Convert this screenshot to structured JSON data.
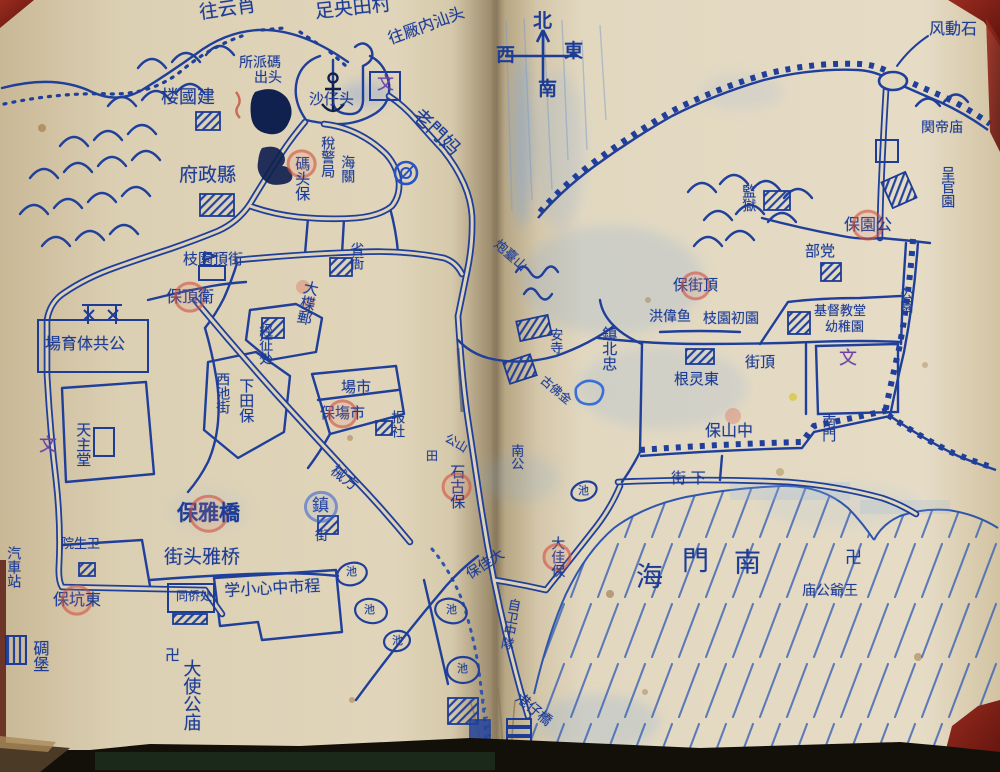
{
  "colors": {
    "ink": "#1c3c96",
    "red_mark": "#cc4a3c",
    "purple": "#7040a8",
    "paper": "#ddd2b6",
    "sea_ink": "#2f56ad"
  },
  "compass": {
    "north": "北",
    "south": "南",
    "east": "東",
    "west": "西"
  },
  "icons": {
    "anchor": "harbor anchor symbol",
    "swastika": "卍 temple mark",
    "compass_arrow": "north arrow cross",
    "wall": "crenellated city wall",
    "pond": "oval pond with 池"
  },
  "map_labels": [
    {
      "id": "route-yunxiao",
      "text": "往云肖",
      "x": 198,
      "y": 4,
      "size": 19,
      "rot": -8
    },
    {
      "id": "route-tianyang",
      "text": "足央田村",
      "x": 314,
      "y": 3,
      "size": 19,
      "rot": -6
    },
    {
      "id": "route-shantou",
      "text": "往厰内汕头",
      "x": 386,
      "y": 32,
      "size": 16,
      "rot": -20
    },
    {
      "id": "paichusuo-line1",
      "text": "所派碼",
      "x": 239,
      "y": 56,
      "size": 14
    },
    {
      "id": "paichusuo-line2",
      "text": "出头",
      "x": 254,
      "y": 71,
      "size": 14
    },
    {
      "id": "jianguolou",
      "text": "楼國建",
      "x": 161,
      "y": 89,
      "size": 18
    },
    {
      "id": "shazaitou",
      "text": "沙仔头",
      "x": 309,
      "y": 92,
      "size": 15
    },
    {
      "id": "wen-top",
      "text": "文",
      "x": 377,
      "y": 76,
      "size": 17,
      "color": "purple"
    },
    {
      "id": "laomenma",
      "text": "老門妈",
      "x": 422,
      "y": 106,
      "size": 19,
      "rot": 44
    },
    {
      "id": "xianzhengfu",
      "text": "府政縣",
      "x": 179,
      "y": 166,
      "size": 19
    },
    {
      "id": "matoubao",
      "text": "碼头保",
      "x": 294,
      "y": 156,
      "size": 15,
      "dir": "v",
      "ring": {
        "index": 0,
        "color": "red"
      }
    },
    {
      "id": "shuijingju",
      "text": "稅警局",
      "x": 320,
      "y": 136,
      "size": 14,
      "dir": "v"
    },
    {
      "id": "haiguan",
      "text": "海關",
      "x": 340,
      "y": 155,
      "size": 14,
      "dir": "v"
    },
    {
      "id": "shengya",
      "text": "省衙",
      "x": 349,
      "y": 242,
      "size": 14,
      "dir": "v"
    },
    {
      "id": "zhiyuan-dingjie",
      "text": "枝園頂街",
      "x": 183,
      "y": 252,
      "size": 15
    },
    {
      "id": "baodingwei",
      "text": "保頂衛",
      "x": 166,
      "y": 289,
      "size": 16,
      "ring": {
        "index": 1,
        "color": "red"
      }
    },
    {
      "id": "dadieyou",
      "text": "大楪郵",
      "x": 304,
      "y": 279,
      "size": 15,
      "dir": "v",
      "rot": 12
    },
    {
      "id": "jingzhengchu",
      "text": "經征处",
      "x": 258,
      "y": 323,
      "size": 14,
      "dir": "v"
    },
    {
      "id": "tiyuchang",
      "text": "場育体共公",
      "x": 45,
      "y": 336,
      "size": 16
    },
    {
      "id": "wen-left",
      "text": "文",
      "x": 39,
      "y": 437,
      "size": 18,
      "color": "purple"
    },
    {
      "id": "tianzhutang",
      "text": "天主堂",
      "x": 75,
      "y": 422,
      "size": 15,
      "dir": "v"
    },
    {
      "id": "xichijie",
      "text": "西池街",
      "x": 215,
      "y": 372,
      "size": 14,
      "dir": "v"
    },
    {
      "id": "xiatianbao",
      "text": "下田保",
      "x": 238,
      "y": 378,
      "size": 15,
      "dir": "v"
    },
    {
      "id": "shichang",
      "text": "場市",
      "x": 341,
      "y": 380,
      "size": 15
    },
    {
      "id": "shichangbao",
      "text": "保塲市",
      "x": 320,
      "y": 406,
      "size": 15,
      "ring": {
        "index": 1,
        "color": "red"
      }
    },
    {
      "id": "baoshe",
      "text": "报社",
      "x": 390,
      "y": 410,
      "size": 14,
      "dir": "v"
    },
    {
      "id": "xiefang",
      "text": "械方",
      "x": 337,
      "y": 463,
      "size": 15,
      "rot": 38
    },
    {
      "id": "zhen-bluering",
      "text": "鎮",
      "x": 312,
      "y": 498,
      "size": 17,
      "ring": {
        "index": 0,
        "color": "blue"
      }
    },
    {
      "id": "jie-below-zhen",
      "text": "街",
      "x": 315,
      "y": 530,
      "size": 13
    },
    {
      "id": "baoyaqiao",
      "text": "保雅橋",
      "x": 177,
      "y": 503,
      "size": 21,
      "bold": true,
      "ring": {
        "index": 1,
        "color": "red"
      }
    },
    {
      "id": "yaqiaotou-jie",
      "text": "街头雅桥",
      "x": 164,
      "y": 548,
      "size": 19
    },
    {
      "id": "tongqiaochu",
      "text": "同侨处",
      "x": 176,
      "y": 590,
      "size": 12
    },
    {
      "id": "zhongxin-xiaoxue",
      "text": "学小心中市程",
      "x": 224,
      "y": 583,
      "size": 16,
      "rot": -3
    },
    {
      "id": "weishengyuan",
      "text": "院生卫",
      "x": 61,
      "y": 538,
      "size": 13
    },
    {
      "id": "qichezhan",
      "text": "汽車站",
      "x": 6,
      "y": 546,
      "size": 14,
      "dir": "v"
    },
    {
      "id": "dongkengbao",
      "text": "保坑東",
      "x": 53,
      "y": 592,
      "size": 16,
      "ring": {
        "index": 1,
        "color": "red"
      }
    },
    {
      "id": "diaobao",
      "text": "碉堡",
      "x": 31,
      "y": 640,
      "size": 16,
      "dir": "v"
    },
    {
      "id": "wan-left",
      "text": "卍",
      "x": 165,
      "y": 648,
      "size": 15
    },
    {
      "id": "dashigongmiao",
      "text": "大使公庙",
      "x": 181,
      "y": 659,
      "size": 18,
      "dir": "v"
    },
    {
      "id": "chi-1",
      "text": "池",
      "x": 346,
      "y": 566,
      "size": 11
    },
    {
      "id": "chi-2",
      "text": "池",
      "x": 364,
      "y": 604,
      "size": 11
    },
    {
      "id": "chi-3",
      "text": "池",
      "x": 392,
      "y": 635,
      "size": 11
    },
    {
      "id": "chi-4",
      "text": "池",
      "x": 446,
      "y": 604,
      "size": 11
    },
    {
      "id": "chi-5",
      "text": "池",
      "x": 457,
      "y": 663,
      "size": 11
    },
    {
      "id": "chi-6",
      "text": "池",
      "x": 578,
      "y": 485,
      "size": 11
    },
    {
      "id": "paotaishan",
      "text": "炮臺山",
      "x": 500,
      "y": 238,
      "size": 13,
      "rot": 42
    },
    {
      "id": "ansi",
      "text": "安寺",
      "x": 548,
      "y": 328,
      "size": 13,
      "dir": "v"
    },
    {
      "id": "gufojin",
      "text": "古佛金",
      "x": 546,
      "y": 374,
      "size": 12,
      "rot": 40
    },
    {
      "id": "nangong",
      "text": "南公",
      "x": 509,
      "y": 444,
      "size": 13,
      "dir": "v"
    },
    {
      "id": "gongshan",
      "text": "公山",
      "x": 449,
      "y": 432,
      "size": 12,
      "rot": 30
    },
    {
      "id": "tian-field",
      "text": "田",
      "x": 426,
      "y": 450,
      "size": 12
    },
    {
      "id": "shigubao",
      "text": "石古保",
      "x": 449,
      "y": 464,
      "size": 15,
      "dir": "v",
      "ring": {
        "index": 1,
        "color": "red"
      }
    },
    {
      "id": "dajiabao-diag",
      "text": "保佳大",
      "x": 464,
      "y": 570,
      "size": 14,
      "rot": -33
    },
    {
      "id": "dajiabao-vert",
      "text": "大佳保",
      "x": 550,
      "y": 536,
      "size": 14,
      "dir": "v",
      "ring": {
        "index": 1,
        "color": "red"
      }
    },
    {
      "id": "ziwei-zhongdui",
      "text": "自卫中隊",
      "x": 507,
      "y": 597,
      "size": 13,
      "dir": "v",
      "rot": 10
    },
    {
      "id": "gangzaiqiao",
      "text": "港仔橋",
      "x": 522,
      "y": 691,
      "size": 14,
      "rot": 40
    },
    {
      "id": "fengdongshi",
      "text": "风動石",
      "x": 929,
      "y": 21,
      "size": 16
    },
    {
      "id": "guandimiao",
      "text": "関帝庙",
      "x": 921,
      "y": 121,
      "size": 14
    },
    {
      "id": "chengguanyuan",
      "text": "呈官園",
      "x": 940,
      "y": 166,
      "size": 14,
      "dir": "v"
    },
    {
      "id": "jianyu",
      "text": "監獄",
      "x": 741,
      "y": 184,
      "size": 14,
      "dir": "v"
    },
    {
      "id": "baoyuangong",
      "text": "保園公",
      "x": 844,
      "y": 217,
      "size": 16,
      "ring": {
        "index": 1,
        "color": "red"
      }
    },
    {
      "id": "budang",
      "text": "部党",
      "x": 805,
      "y": 244,
      "size": 15
    },
    {
      "id": "gongyuan",
      "text": "公園",
      "x": 898,
      "y": 287,
      "size": 13,
      "dir": "v"
    },
    {
      "id": "baojieding",
      "text": "保街頂",
      "x": 673,
      "y": 278,
      "size": 15,
      "ring": {
        "index": 1,
        "color": "red"
      }
    },
    {
      "id": "hongweiyu",
      "text": "洪偉鱼",
      "x": 649,
      "y": 310,
      "size": 14
    },
    {
      "id": "zhiyuan-chuyuan",
      "text": "枝園初園",
      "x": 703,
      "y": 312,
      "size": 14
    },
    {
      "id": "jidujiaotang",
      "text": "基督教堂",
      "x": 814,
      "y": 305,
      "size": 13
    },
    {
      "id": "youzhiyuan",
      "text": "幼稚園",
      "x": 825,
      "y": 321,
      "size": 13
    },
    {
      "id": "wen-right",
      "text": "文",
      "x": 839,
      "y": 350,
      "size": 18,
      "color": "purple"
    },
    {
      "id": "zhenbeizhong",
      "text": "鎮北忠",
      "x": 601,
      "y": 326,
      "size": 15,
      "dir": "v"
    },
    {
      "id": "genglingdong",
      "text": "根灵東",
      "x": 674,
      "y": 372,
      "size": 15
    },
    {
      "id": "jieding",
      "text": "街頂",
      "x": 745,
      "y": 355,
      "size": 15
    },
    {
      "id": "zhongshanbao",
      "text": "保山中",
      "x": 705,
      "y": 423,
      "size": 16
    },
    {
      "id": "nanmen",
      "text": "南門",
      "x": 821,
      "y": 414,
      "size": 14,
      "dir": "v"
    },
    {
      "id": "xiajie",
      "text": "街 下",
      "x": 671,
      "y": 471,
      "size": 15
    },
    {
      "id": "sea-hai",
      "text": "海",
      "x": 636,
      "y": 564,
      "size": 27
    },
    {
      "id": "sea-men",
      "text": "門",
      "x": 682,
      "y": 548,
      "size": 27
    },
    {
      "id": "sea-nan",
      "text": "南",
      "x": 734,
      "y": 550,
      "size": 27
    },
    {
      "id": "wan-right",
      "text": "卍",
      "x": 845,
      "y": 550,
      "size": 17
    },
    {
      "id": "wangyegongmiao",
      "text": "庙公爺王",
      "x": 802,
      "y": 584,
      "size": 14
    }
  ]
}
